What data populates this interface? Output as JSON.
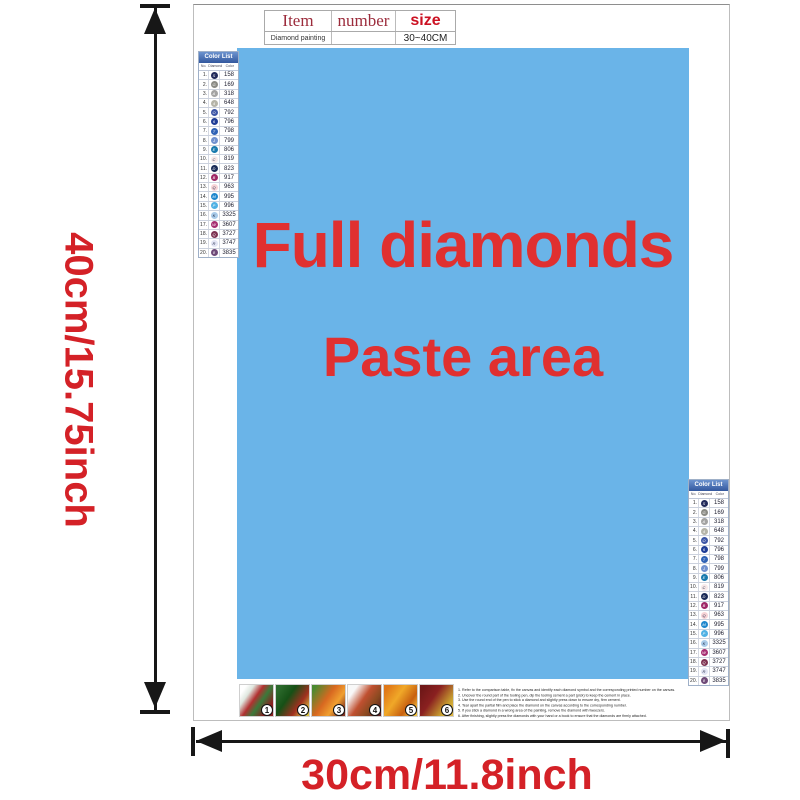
{
  "colors": {
    "paste_bg": "#6ab4e8",
    "paste_text_red": "#e03030",
    "dimension_red": "#d42127",
    "list_header_blue": "#33589e"
  },
  "dimension_labels": {
    "height": "40cm/15.75inch",
    "width": "30cm/11.8inch"
  },
  "item_table": {
    "headers": [
      "Item",
      "number",
      "size"
    ],
    "row": [
      "Diamond painting",
      "",
      "30~40CM"
    ]
  },
  "paste_area": {
    "line1": "Full diamonds",
    "line2": "Paste area"
  },
  "color_list": {
    "title": "Color List",
    "columns": [
      "No.",
      "Diamond",
      "Color"
    ],
    "rows": [
      {
        "no": "1",
        "sym": "S",
        "code": "158",
        "bg": "#20295a",
        "fg": "#ffffff"
      },
      {
        "no": "2",
        "sym": "G",
        "code": "169",
        "bg": "#8a8a84",
        "fg": "#ffffff"
      },
      {
        "no": "3",
        "sym": "A",
        "code": "318",
        "bg": "#a3a3a2",
        "fg": "#ffffff"
      },
      {
        "no": "4",
        "sym": "4",
        "code": "648",
        "bg": "#b5b4a8",
        "fg": "#ffffff"
      },
      {
        "no": "5",
        "sym": "O",
        "code": "792",
        "bg": "#3c55a5",
        "fg": "#ffffff"
      },
      {
        "no": "6",
        "sym": "6",
        "code": "796",
        "bg": "#1e3c96",
        "fg": "#ffffff"
      },
      {
        "no": "7",
        "sym": "T",
        "code": "798",
        "bg": "#2f62b5",
        "fg": "#ffffff"
      },
      {
        "no": "8",
        "sym": "J",
        "code": "799",
        "bg": "#7191cf",
        "fg": "#ffffff"
      },
      {
        "no": "9",
        "sym": "E",
        "code": "806",
        "bg": "#1779ad",
        "fg": "#ffffff"
      },
      {
        "no": "10",
        "sym": "C",
        "code": "819",
        "bg": "#f8e9e9",
        "fg": "#2a3350"
      },
      {
        "no": "11",
        "sym": "D",
        "code": "823",
        "bg": "#1a2a57",
        "fg": "#ffffff"
      },
      {
        "no": "12",
        "sym": "B",
        "code": "917",
        "bg": "#9e2766",
        "fg": "#ffffff"
      },
      {
        "no": "13",
        "sym": "Q",
        "code": "963",
        "bg": "#f7d3d6",
        "fg": "#2a3350"
      },
      {
        "no": "14",
        "sym": "M",
        "code": "995",
        "bg": "#1e87cd",
        "fg": "#ffffff"
      },
      {
        "no": "15",
        "sym": "P",
        "code": "996",
        "bg": "#4fb1e4",
        "fg": "#ffffff"
      },
      {
        "no": "16",
        "sym": "K",
        "code": "3325",
        "bg": "#a9cbe9",
        "fg": "#1c2540"
      },
      {
        "no": "17",
        "sym": "W",
        "code": "3607",
        "bg": "#a62d71",
        "fg": "#ffffff"
      },
      {
        "no": "18",
        "sym": "Q",
        "code": "3727",
        "bg": "#7c3150",
        "fg": "#ffffff"
      },
      {
        "no": "19",
        "sym": "R",
        "code": "3747",
        "bg": "#e2e5f4",
        "fg": "#2a3350"
      },
      {
        "no": "20",
        "sym": "8",
        "code": "3835",
        "bg": "#6f4a78",
        "fg": "#ffffff"
      }
    ]
  },
  "steps": [
    "1",
    "2",
    "3",
    "4",
    "5",
    "6"
  ],
  "instructions": {
    "lines": [
      "1. Refer to the comparison table, fix the canvas and identify each diamond symbol and the corresponding printed number on the canvas.",
      "2. Uncover the round part of the tooling pen, dip the tooling cement a part (pick) to keep the cement in place.",
      "3. Use the round end of the pen to stick a diamond and slightly press down to ensure dry, firm cement.",
      "4. Tear apart the partial film and place the diamond on the canvas according to the corresponding number.",
      "5. If you stick a diamond in a wrong area of the painting, remove the diamond with tweezers.",
      "6. After finishing, slightly press the diamonds with your hand or a book to ensure that the diamonds are firmly attached."
    ]
  }
}
